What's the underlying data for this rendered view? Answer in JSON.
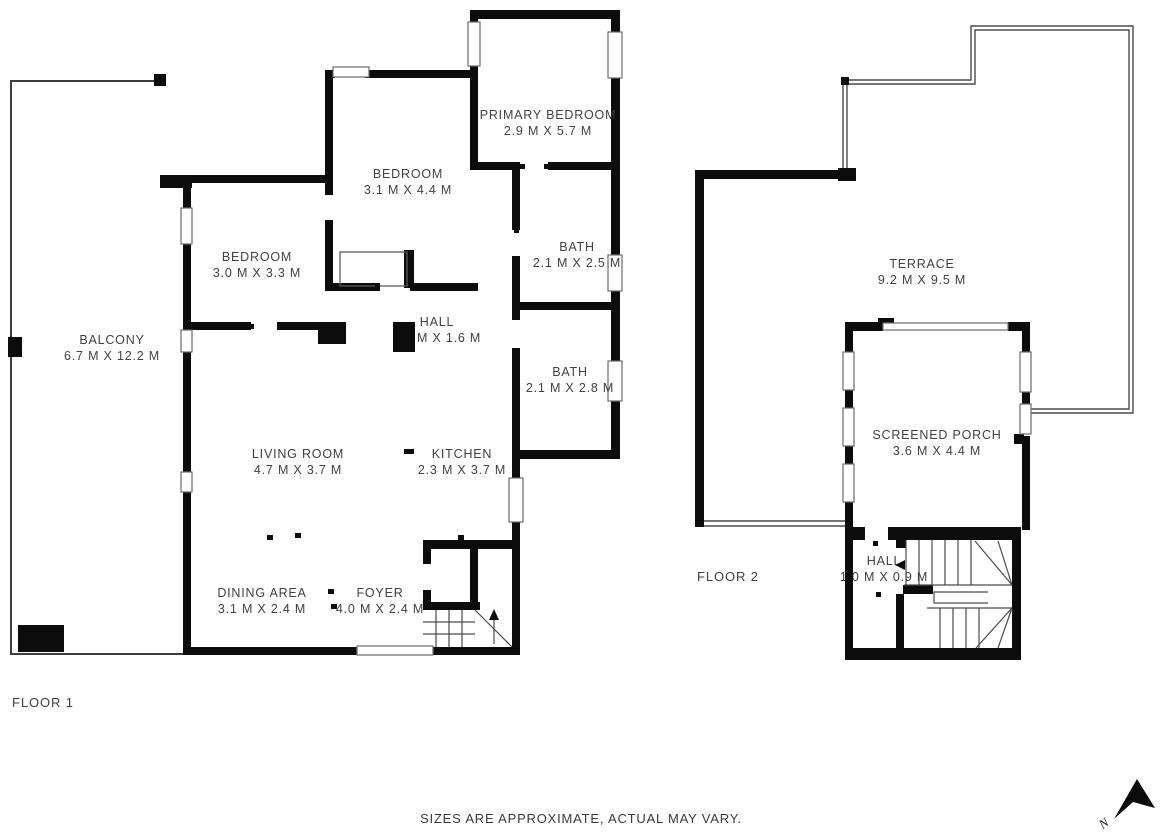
{
  "floor1": {
    "label": "FLOOR 1",
    "rooms": [
      {
        "name": "PRIMARY BEDROOM",
        "dims": "2.9 M X 5.7 M"
      },
      {
        "name": "BEDROOM",
        "dims": "3.1 M X 4.4 M"
      },
      {
        "name": "BEDROOM",
        "dims": "3.0 M X 3.3 M"
      },
      {
        "name": "BATH",
        "dims": "2.1 M X 2.5 M"
      },
      {
        "name": "HALL",
        "dims": "1.9 M X 1.6 M"
      },
      {
        "name": "BATH",
        "dims": "2.1 M X 2.8 M"
      },
      {
        "name": "BALCONY",
        "dims": "6.7 M X 12.2 M"
      },
      {
        "name": "LIVING ROOM",
        "dims": "4.7 M X 3.7 M"
      },
      {
        "name": "KITCHEN",
        "dims": "2.3 M X 3.7 M"
      },
      {
        "name": "DINING AREA",
        "dims": "3.1 M X 2.4 M"
      },
      {
        "name": "FOYER",
        "dims": "4.0 M X 2.4 M"
      }
    ]
  },
  "floor2": {
    "label": "FLOOR 2",
    "rooms": [
      {
        "name": "TERRACE",
        "dims": "9.2 M X 9.5 M"
      },
      {
        "name": "SCREENED PORCH",
        "dims": "3.6 M X 4.4 M"
      },
      {
        "name": "HALL",
        "dims": "1.0 M X 0.9 M"
      }
    ]
  },
  "footer": {
    "disclaimer": "SIZES ARE APPROXIMATE, ACTUAL MAY VARY."
  },
  "compass": {
    "label": "N"
  },
  "colors": {
    "wall": "#0c0c0c",
    "text": "#414141",
    "background": "#ffffff"
  }
}
